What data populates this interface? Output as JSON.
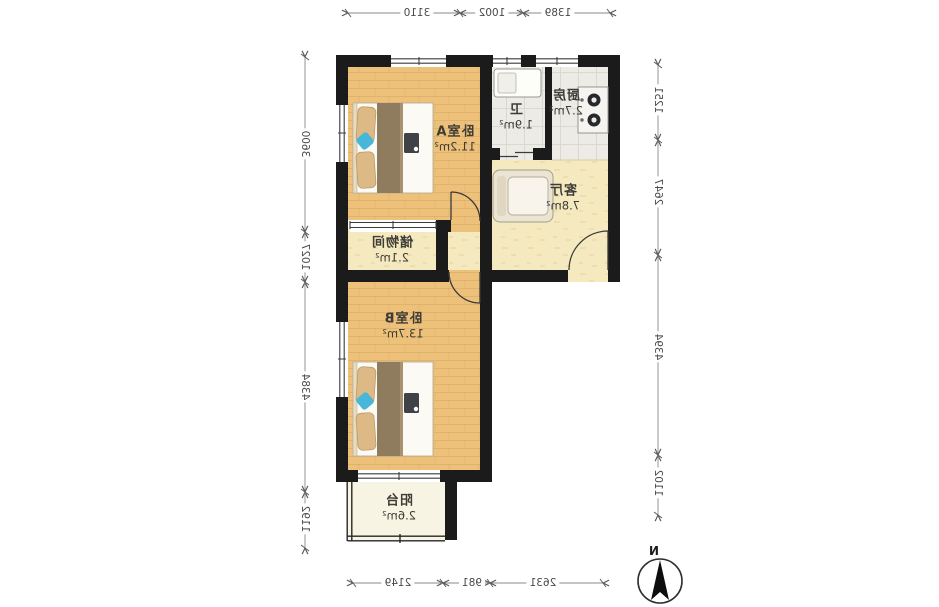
{
  "floorplan": {
    "mirrored": true,
    "rooms": [
      {
        "id": "bedroom-a",
        "name": "卧室A",
        "area": "11.2m²"
      },
      {
        "id": "bathroom",
        "name": "卫",
        "area": "1.9m²"
      },
      {
        "id": "kitchen",
        "name": "厨房",
        "area": "2.7m²"
      },
      {
        "id": "living-room",
        "name": "客厅",
        "area": "7.8m²"
      },
      {
        "id": "storage",
        "name": "储物间",
        "area": "2.1m²"
      },
      {
        "id": "bedroom-b",
        "name": "卧室B",
        "area": "13.7m²"
      },
      {
        "id": "balcony",
        "name": "阳台",
        "area": "2.6m²"
      }
    ],
    "dimensions": {
      "top": [
        "3110",
        "1002",
        "1389"
      ],
      "bottom": [
        "2149",
        "981",
        "2631"
      ],
      "left": [
        "3600",
        "1027",
        "4384",
        "1192"
      ],
      "right": [
        "1251",
        "2647",
        "4394",
        "1102"
      ]
    },
    "compass": {
      "label": "N"
    },
    "colors": {
      "wall": "#1b1b1b",
      "wood_floor": "#eec17b",
      "tile_floor": "#ecebe6",
      "hall_floor": "#f5e9c0",
      "balcony_floor": "#f8f4e3",
      "pillow": "#ddb985",
      "blanket": "#8f7b5d",
      "accent_blue": "#46b7d8",
      "dim_text": "#4a4a4a"
    }
  }
}
